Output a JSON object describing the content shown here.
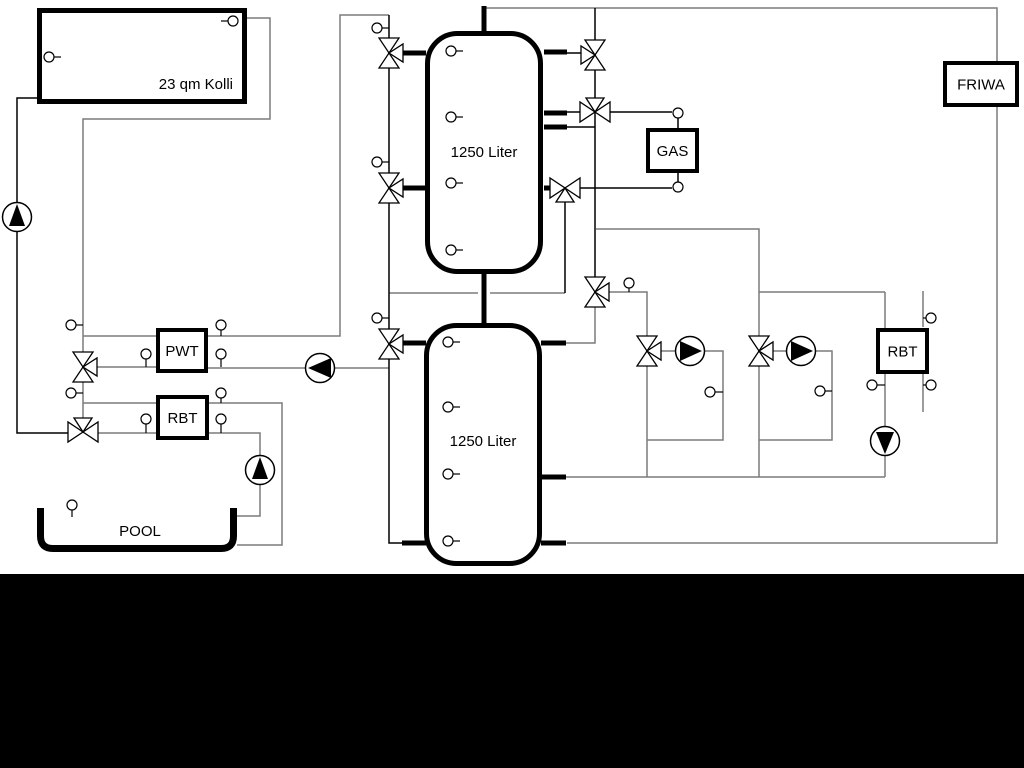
{
  "window": {
    "background": "#ffffff",
    "letterbox_color": "#000000"
  },
  "diagram": {
    "labels": {
      "collector": "23 qm Kolli",
      "tank1": "1250 Liter",
      "tank2": "1250 Liter",
      "gas": "GAS",
      "friwa": "FRIWA",
      "pwt": "PWT",
      "rbt_left": "RBT",
      "rbt_right": "RBT",
      "pool": "POOL"
    },
    "colors": {
      "pipe_gray": "#7b7b7b",
      "line_black": "#000000",
      "component_fill": "#ffffff"
    },
    "components": {
      "boxes": [
        "solar-collector",
        "buffer-tank-1",
        "buffer-tank-2",
        "gas-boiler",
        "friwa-station",
        "pwt-heat-exchanger",
        "rbt-left",
        "rbt-right",
        "pool-basin"
      ],
      "pumps": [
        {
          "name": "solar-pump",
          "direction": "up"
        },
        {
          "name": "tank-charge-pump",
          "direction": "left"
        },
        {
          "name": "pool-pump",
          "direction": "up"
        },
        {
          "name": "heating-circuit-1-pump",
          "direction": "right"
        },
        {
          "name": "heating-circuit-2-pump",
          "direction": "right"
        },
        {
          "name": "rbt-right-pump",
          "direction": "down"
        }
      ],
      "three_way_valves": 11,
      "temperature_sensors": 30
    }
  }
}
